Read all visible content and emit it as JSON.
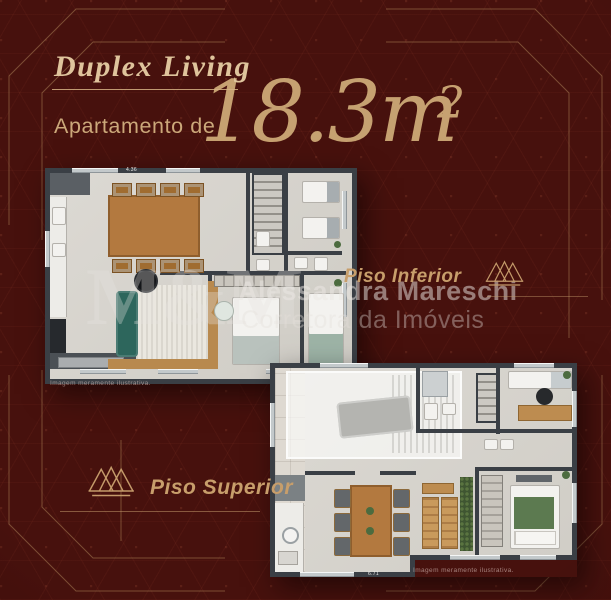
{
  "header": {
    "title": "Duplex Living",
    "subtitle": "Apartamento de",
    "area_number": "18.3",
    "area_unit": "m",
    "area_exponent": "2"
  },
  "watermark": {
    "monogram": "M&M",
    "name": "Alessandra Mareschi",
    "tagline": "Corretora da Imóveis"
  },
  "floor_lower": {
    "label": "Piso Inferior",
    "disclaimer": "Imagem meramente ilustrativa.",
    "dimension_top": "4.36"
  },
  "floor_upper": {
    "label": "Piso Superior",
    "disclaimer": "Imagem meramente ilustrativa.",
    "dimension_bottom": "6.71"
  },
  "icons": {
    "crown": "crown-icon"
  },
  "colors": {
    "background": "#47110d",
    "gold": "#c79e6b",
    "gold_light": "#dfc49c",
    "wall": "#3a3f45",
    "floor": "#d8d5cf",
    "sofa_teal": "#2d665c",
    "wood": "#b3793f",
    "bed_green": "#5c7a50"
  }
}
